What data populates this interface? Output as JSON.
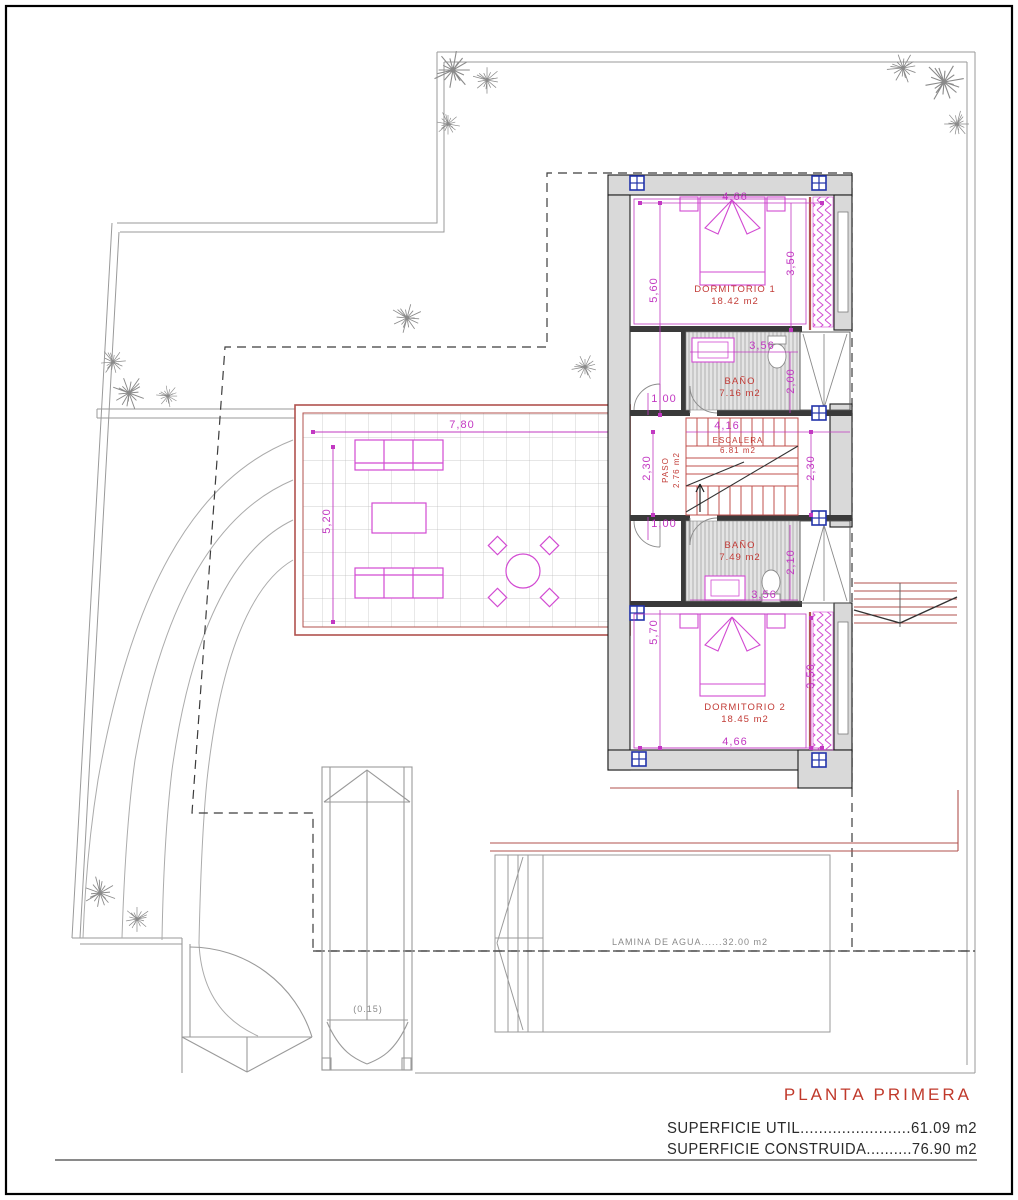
{
  "drawing": {
    "title": "PLANTA  PRIMERA",
    "summary_util": "SUPERFICIE  UTIL........................61.09  m2",
    "summary_construida": "SUPERFICIE  CONSTRUIDA..........76.90  m2"
  },
  "rooms": {
    "dormitorio1": {
      "name": "DORMITORIO  1",
      "area": "18.42  m2"
    },
    "bano1": {
      "name": "BAÑO",
      "area": "7.16  m2"
    },
    "escalera": {
      "name": "ESCALERA",
      "area": "6.81  m2"
    },
    "paso": {
      "name": "PASO",
      "area": "2.76 m2"
    },
    "bano2": {
      "name": "BAÑO",
      "area": "7.49  m2"
    },
    "dormitorio2": {
      "name": "DORMITORIO  2",
      "area": "18.45  m2"
    }
  },
  "pool": {
    "label": "LAMINA  DE  AGUA......32.00  m2"
  },
  "entrance": {
    "threshold": "(0.15)"
  },
  "dims": {
    "d466a": "4,66",
    "d350a": "3,50",
    "d560": "5,60",
    "d356a": "3,56",
    "d200": "2,00",
    "d100a": "1,00",
    "d416": "4,16",
    "d230a": "2,30",
    "d230b": "2,30",
    "d100b": "1,00",
    "d210": "2,10",
    "d356b": "3,56",
    "d570": "5,70",
    "d350b": "3,50",
    "d466b": "4,66",
    "d780": "7,80",
    "d520": "5,20"
  },
  "colors": {
    "wall_fill": "#d9d9d9",
    "wall_line": "#1a1a1a",
    "lower_floor_red": "#b0524e",
    "label_red": "#c23b36",
    "dimension_magenta": "#c238c2",
    "furniture_magenta": "#d24ad2",
    "column_blue": "#2233aa",
    "site_gray": "#9a9a9a"
  }
}
